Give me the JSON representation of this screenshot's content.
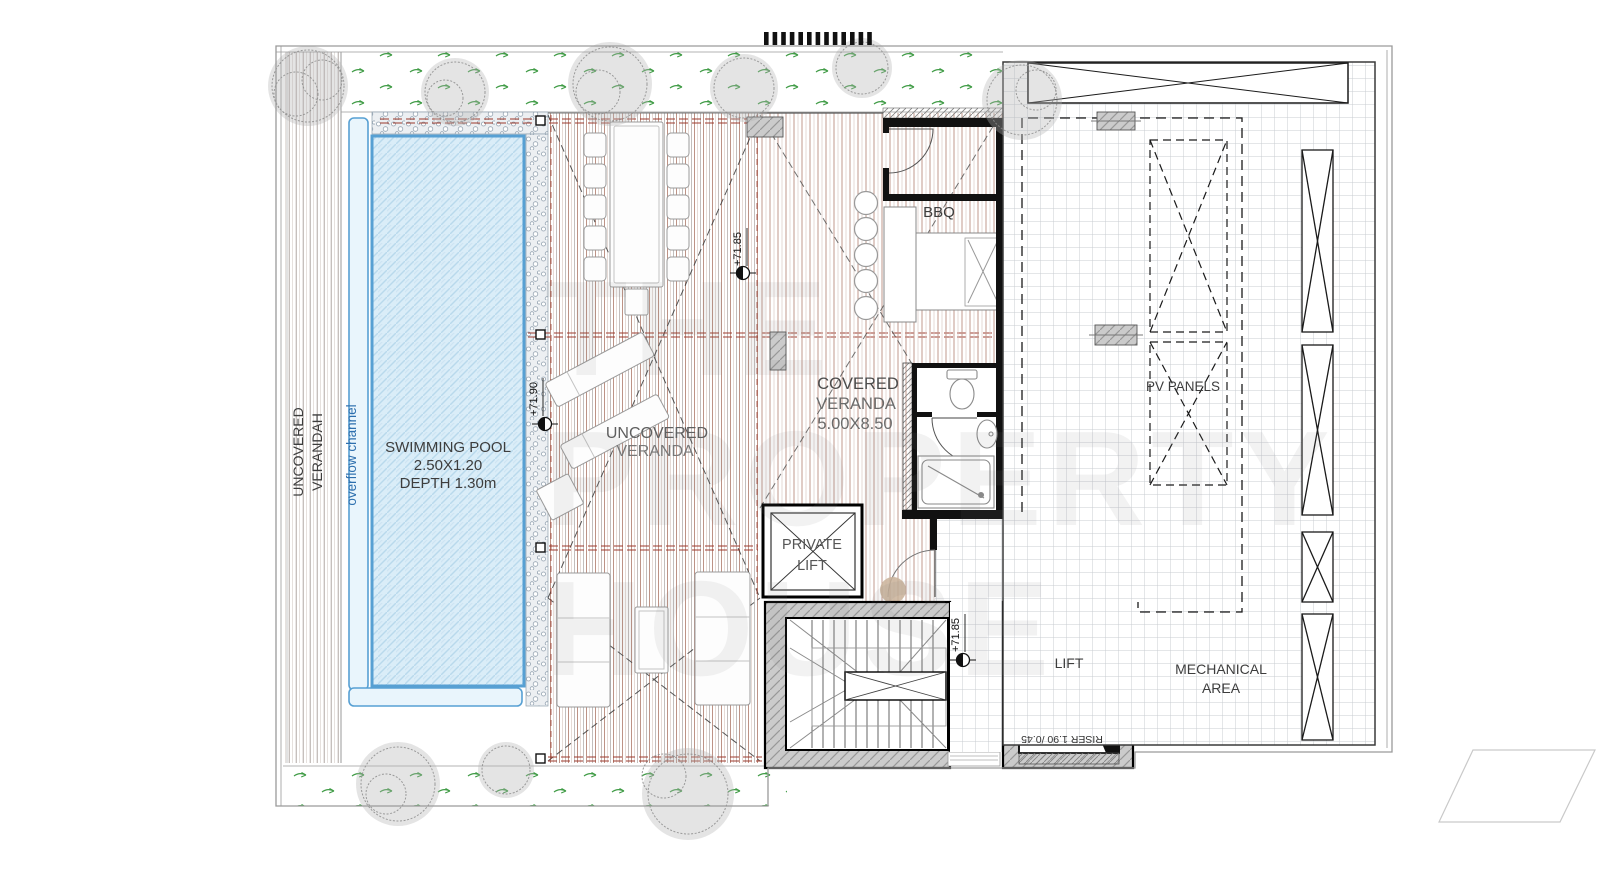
{
  "labels": {
    "side_verandah": [
      "UNCOVERED",
      "VERANDAH"
    ],
    "overflow": "overflow channel",
    "pool": [
      "SWIMMING POOL",
      "2.50X1.20",
      "DEPTH 1.30m"
    ],
    "uncovered": [
      "UNCOVERED",
      "VERANDA"
    ],
    "covered": [
      "COVERED",
      "VERANDA",
      "5.00X8.50"
    ],
    "bbq": "BBQ",
    "private_lift": [
      "PRIVATE",
      "LIFT"
    ],
    "lift": "LIFT",
    "riser": "RISER 1.90 /0.45",
    "mechanical": [
      "MECHANICAL",
      "AREA"
    ],
    "pv": "PV PANELS"
  },
  "levels": {
    "deck": "+71.85",
    "stair": "+71.85",
    "pool": "+71.90"
  },
  "watermark": [
    "THE",
    "PROPERTY",
    "HOUSE"
  ],
  "colors": {
    "pool_water": "#daedf8",
    "pool_border": "#57a0d3",
    "overflow_text": "#2d6fae",
    "deck_board": "#bd9386",
    "grass_arrow": "#3f9b45",
    "wall_fill": "#cbcbcb",
    "label_text": "#3d3d3d",
    "beam_red": "#9c3a2c"
  }
}
